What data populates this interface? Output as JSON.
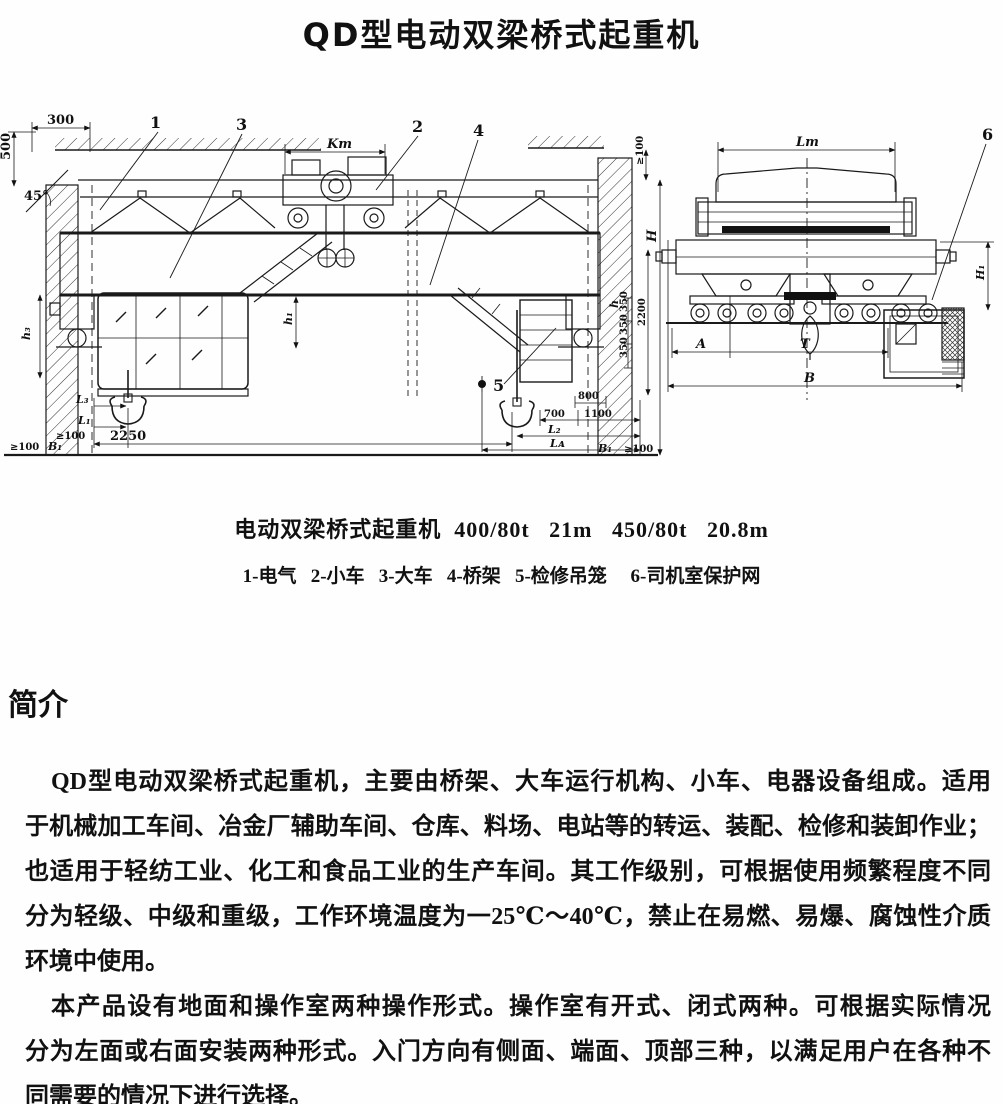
{
  "page": {
    "title": "QD型电动双梁桥式起重机"
  },
  "figure": {
    "caption": "电动双梁桥式起重机  400/80t   21m   450/80t   20.8m",
    "legend": "1-电气   2-小车   3-大车   4-桥架   5-检修吊笼     6-司机室保护网",
    "callouts": {
      "c1": "1",
      "c2": "2",
      "c3": "3",
      "c4": "4",
      "c5": "5",
      "c6": "6"
    },
    "dims": {
      "d300": "300",
      "d500": "500",
      "d45": "45°",
      "kt": "Kт",
      "ge100": "≥100",
      "H": "H",
      "h": "h",
      "h1": "h₁",
      "h3": "h₃",
      "L1": "L₁",
      "L2": "L₂",
      "L3": "L₃",
      "LA": "Lᴀ",
      "B1": "B₁",
      "d2250": "2250",
      "d700": "700",
      "d1100": "1100",
      "d800": "800",
      "d350": "350",
      "d2200": "2200",
      "LT": "Lт",
      "H1": "H₁",
      "A": "A",
      "T": "T",
      "B": "B"
    }
  },
  "intro": {
    "heading": "简介",
    "paragraphs": [
      {
        "lines": [
          {
            "text": "QD型电动双梁桥式起重机，主要由桥架、大车运行机构、小车、电器设备组成。适用",
            "indent": true,
            "last": false
          },
          {
            "text": "于机械加工车间、冶金厂辅助车间、仓库、料场、电站等的转运、装配、检修和装卸作业；",
            "indent": false,
            "last": false
          },
          {
            "text": "也适用于轻纺工业、化工和食品工业的生产车间。其工作级别，可根据使用频繁程度不同",
            "indent": false,
            "last": false
          },
          {
            "text": "分为轻级、中级和重级，工作环境温度为一25℃～40℃，禁止在易燃、易爆、腐蚀性介质",
            "indent": false,
            "last": false
          },
          {
            "text": "环境中使用。",
            "indent": false,
            "last": true
          }
        ]
      },
      {
        "lines": [
          {
            "text": "本产品设有地面和操作室两种操作形式。操作室有开式、闭式两种。可根据实际情况",
            "indent": true,
            "last": false
          },
          {
            "text": "分为左面或右面安装两种形式。入门方向有侧面、端面、顶部三种，以满足用户在各种不",
            "indent": false,
            "last": false
          },
          {
            "text": "同需要的情况下进行选择。",
            "indent": false,
            "last": true
          }
        ]
      }
    ]
  }
}
